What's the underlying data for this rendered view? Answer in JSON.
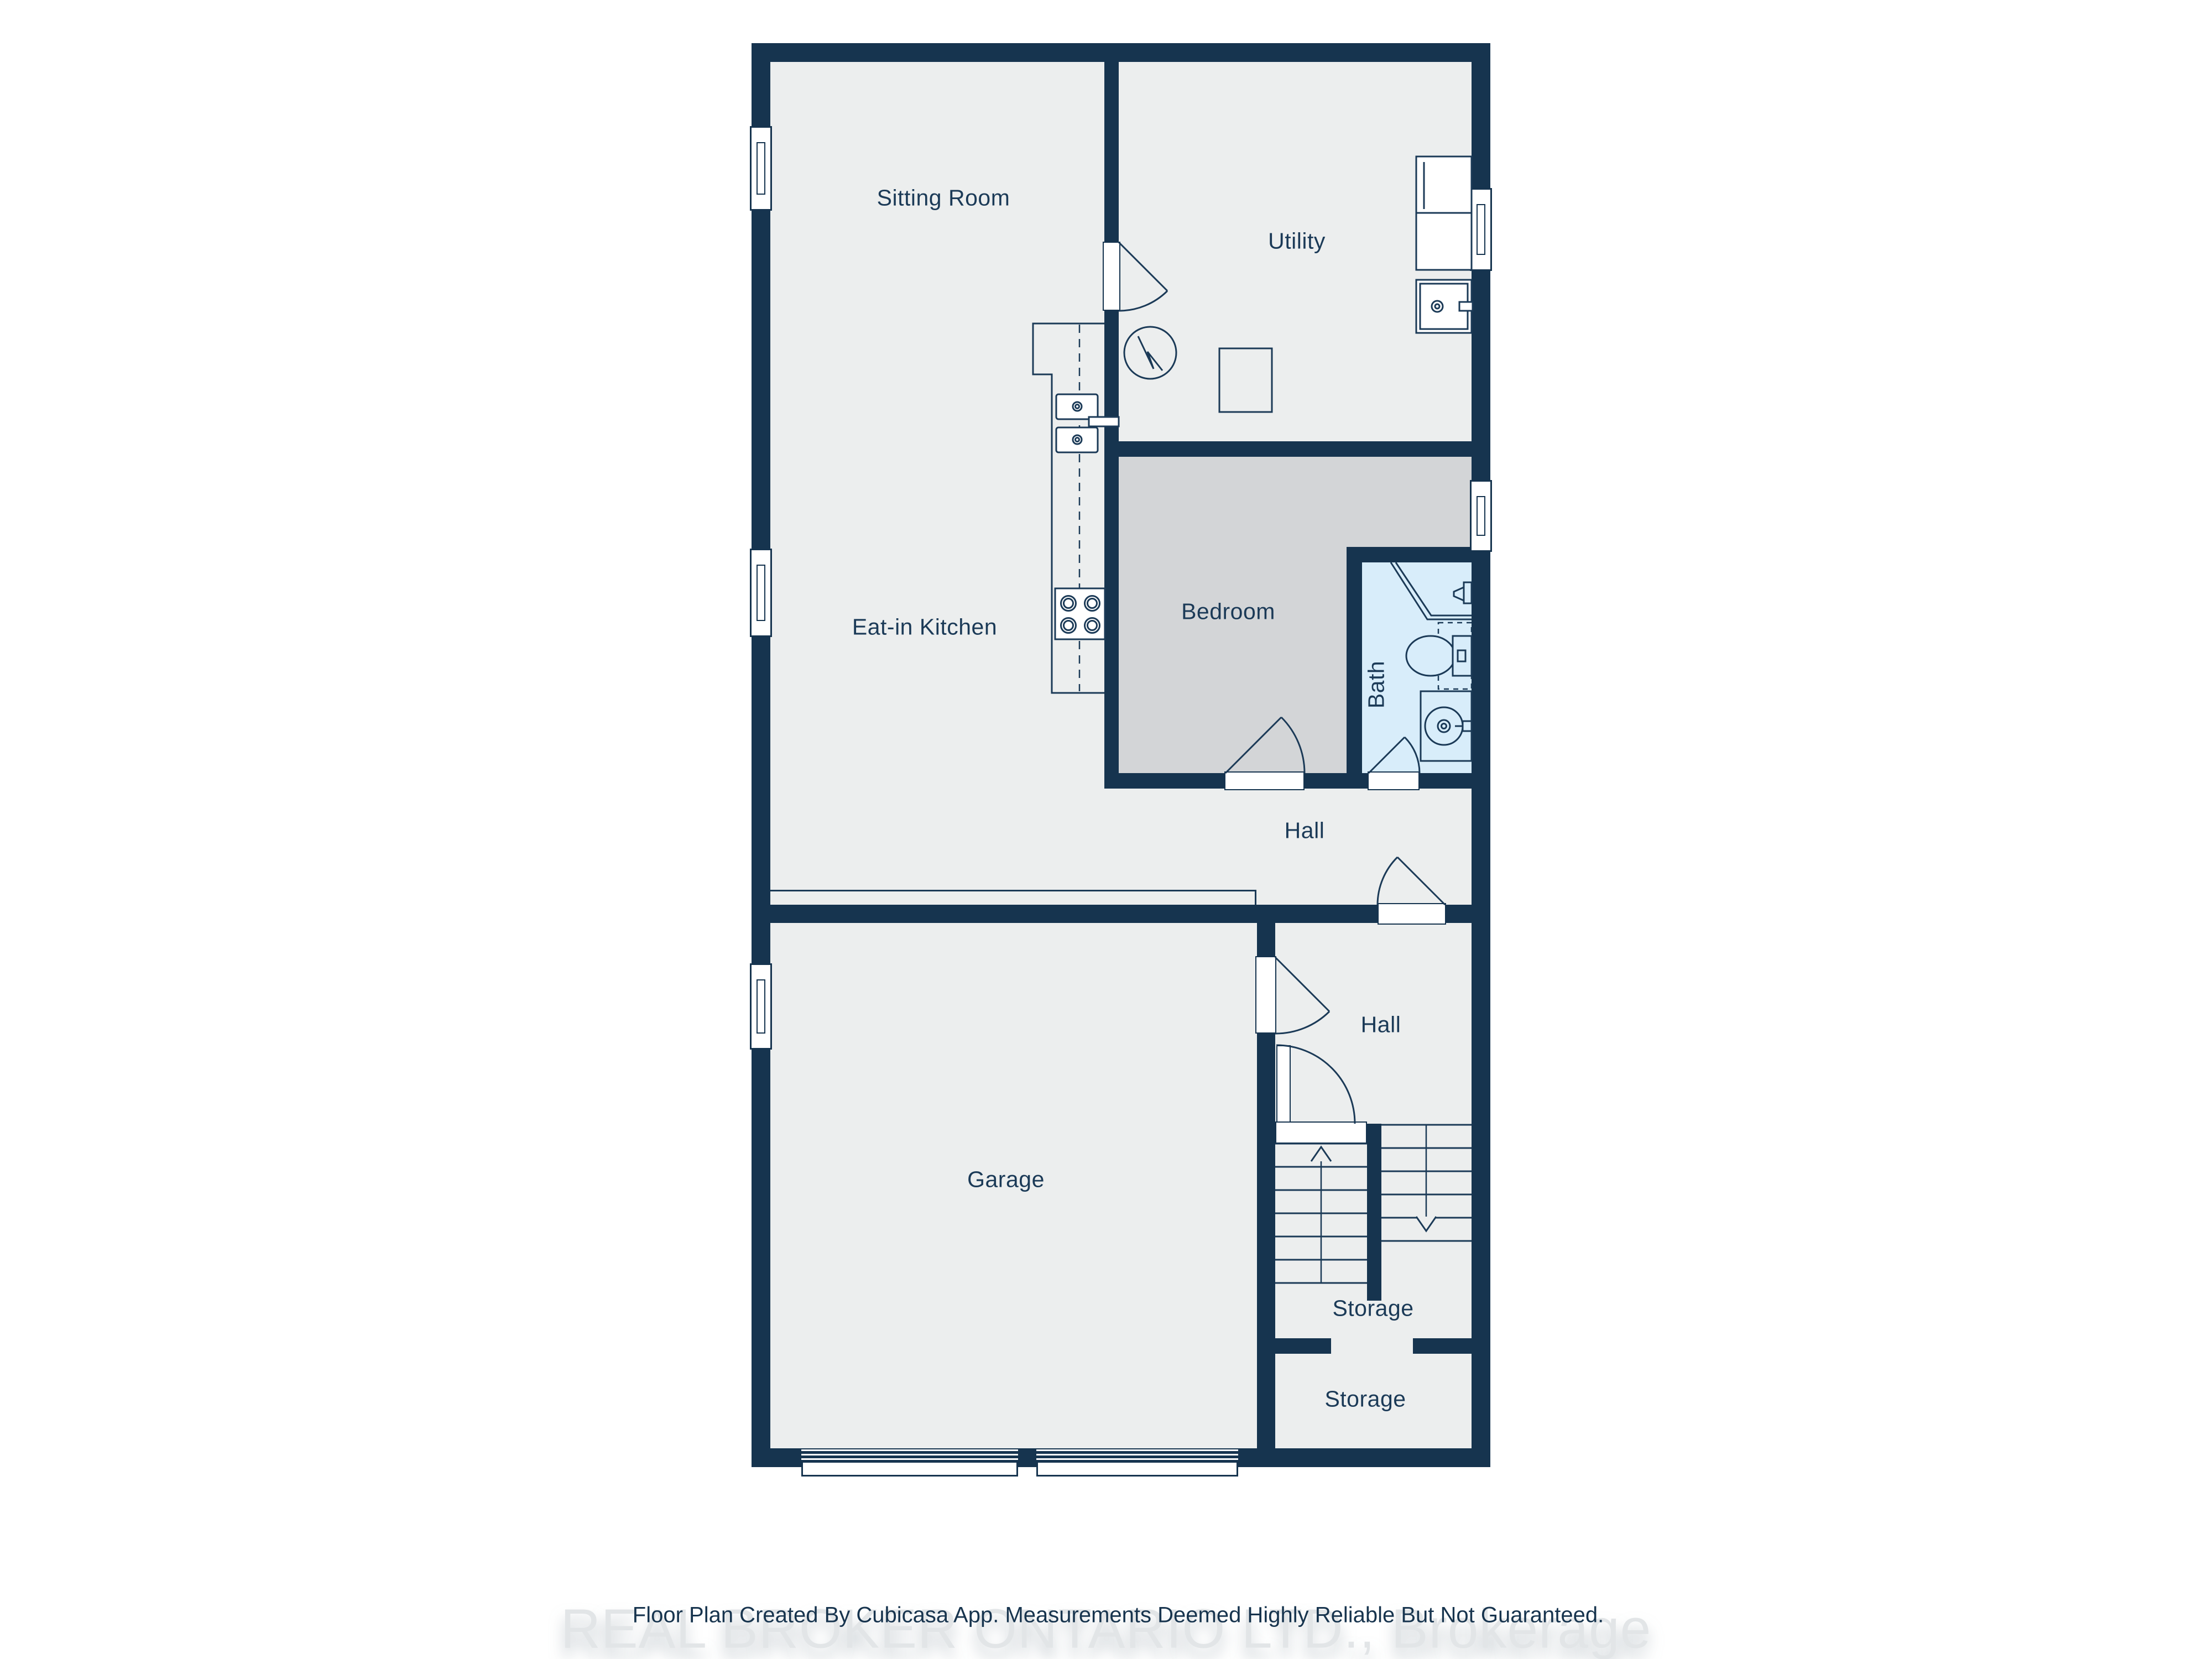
{
  "floor_plan": {
    "rooms": {
      "sitting_room": "Sitting Room",
      "utility": "Utility",
      "eat_in_kitchen": "Eat-in Kitchen",
      "bedroom": "Bedroom",
      "bath": "Bath",
      "hall_upper": "Hall",
      "hall_lower": "Hall",
      "garage": "Garage",
      "storage_under_stairs": "Storage",
      "storage_lower": "Storage"
    },
    "colors": {
      "wall": "#16344F",
      "floor": "#ECEEEE",
      "bedroom_floor": "#D3D5D7",
      "bath_floor": "#D8EDFA",
      "stroke": "#1B3A57",
      "label_text": "#1B3A57",
      "watermark_gray": "#E2E5E7",
      "page_background": "#FFFFFF"
    },
    "icons": [
      "window-icon",
      "door-swing-icon",
      "stove-icon",
      "kitchen-sink-icon",
      "water-heater-icon",
      "furnace-icon",
      "washer-icon",
      "cabinet-icon",
      "shower-icon",
      "toilet-icon",
      "vanity-sink-icon",
      "stairs-up-arrow-icon",
      "stairs-down-arrow-icon",
      "garage-door-icon"
    ]
  },
  "footer": {
    "disclaimer": "Floor Plan Created By Cubicasa App. Measurements Deemed Highly Reliable But Not Guaranteed.",
    "watermark": "REAL BROKER ONTARIO LTD., Brokerage"
  }
}
